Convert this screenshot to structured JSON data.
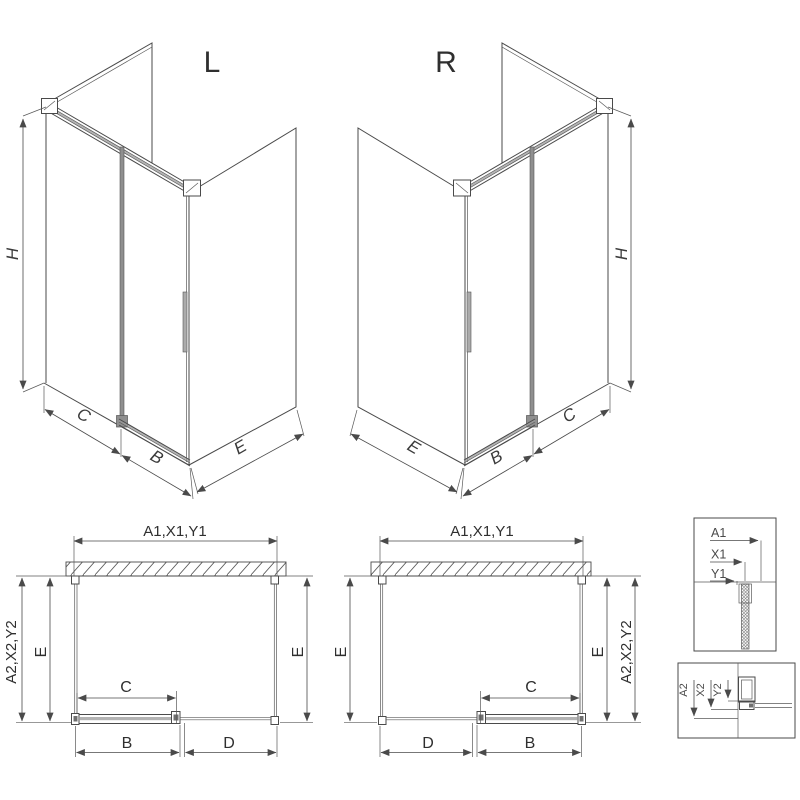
{
  "drawing": {
    "colors": {
      "line": "#4a4a4a",
      "text": "#2f2f2f",
      "profile_gray": "#8f8f8f",
      "background": "#ffffff"
    },
    "iso_left": {
      "label": "L",
      "height": "H",
      "fixed": "C",
      "door": "B",
      "side": "E"
    },
    "iso_right": {
      "label": "R",
      "height": "H",
      "fixed": "C",
      "door": "B",
      "side": "E"
    },
    "plan_left": {
      "width": "A1,X1,Y1",
      "depth_outer": "A2,X2,Y2",
      "depth_left": "E",
      "depth_right": "E",
      "glass": "C",
      "door": "B",
      "opening": "D"
    },
    "plan_right": {
      "width": "A1,X1,Y1",
      "depth_outer": "A2,X2,Y2",
      "depth_left": "E",
      "depth_right": "E",
      "glass": "C",
      "door": "B",
      "opening": "D"
    },
    "detail_wall_profile": {
      "a": "A1",
      "x": "X1",
      "y": "Y1"
    },
    "detail_floor_profile": {
      "a": "A2",
      "x": "X2",
      "y": "Y2"
    }
  }
}
